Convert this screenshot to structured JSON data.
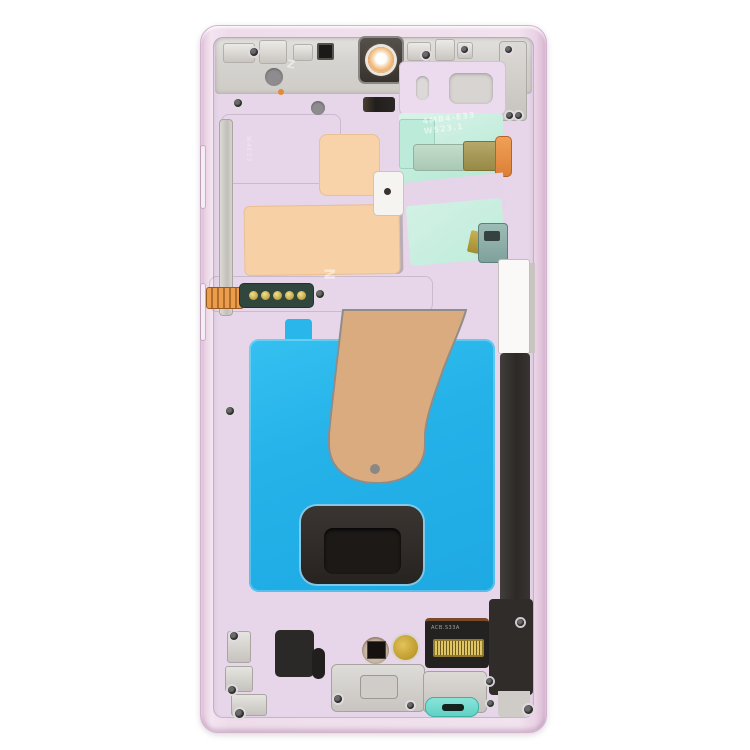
{
  "scene": {
    "type": "product-photo",
    "subject": "Smartphone mid-frame / LCD housing replacement part, internal rear view",
    "part_color_name": "pink lavender",
    "background": "#ffffff"
  },
  "markings": {
    "top_left": "Z",
    "left_vertical": "W4E23",
    "mid_plate": "N",
    "sticker_line1": "4MB4-E33",
    "sticker_line2": "W523.1",
    "connector_label": "ACB.S33A"
  },
  "colors": {
    "frame_pink": "#ecd9ea",
    "plate_lavender": "#e7d6e9",
    "metal_silver": "#d6d4d0",
    "display_adhesive_blue": "#27b4ea",
    "foam_pad_peach": "#f8d0a6",
    "film_mint": "#c2ecdb",
    "ribbon_tan": "#d9ab7e",
    "flex_copper": "#e0883f",
    "pcb_green": "#31473e",
    "contact_gold": "#c9a232",
    "spen_silo_black": "#2c2927",
    "spen_cap_teal": "#6fd9cd"
  }
}
